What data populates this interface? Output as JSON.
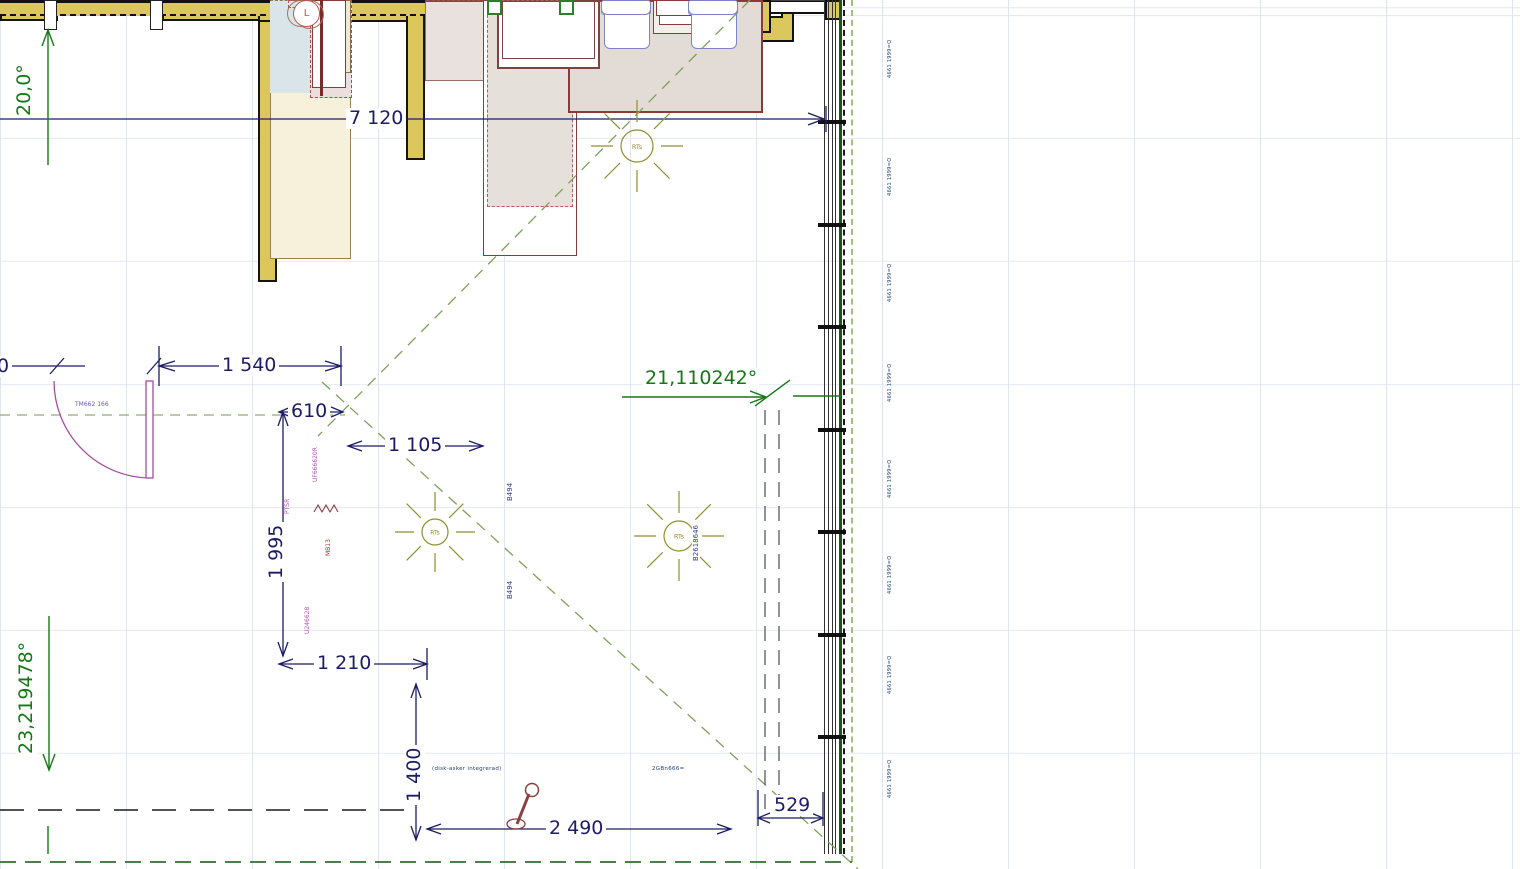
{
  "dims": {
    "d7120": "7 120",
    "d1540": "1 540",
    "d610": "610",
    "d1105": "1 105",
    "d1995": "1 995",
    "d1210": "1 210",
    "d1400": "1 400",
    "d2490": "2 490",
    "d529": "529",
    "d0": "0"
  },
  "angles": {
    "up": "20,0°",
    "down": "23,219478°",
    "column": "21,110242°"
  },
  "labels": {
    "door": "TM662 166",
    "light": "RTs",
    "cabinet_upper": "UF666620R",
    "sink_note": "PTSR",
    "sink_unit": "MB13",
    "cabinet_lower": "U246628",
    "lamp": "L",
    "bench_seat": "B494",
    "table": "B2618646",
    "dishwasher": "(disk-asker integrerad)",
    "oven": "2GBn666=",
    "wall_segment": "4661 1999=O"
  },
  "colors": {
    "wall": "#dcc75e",
    "dimension_text": "#1c1c66",
    "annotation_green": "#157815",
    "furniture_outline": "#8b3a3a",
    "chair_outline": "#7d84c2",
    "door": "#a24fa2",
    "light_symbol": "#8f8f2e"
  }
}
